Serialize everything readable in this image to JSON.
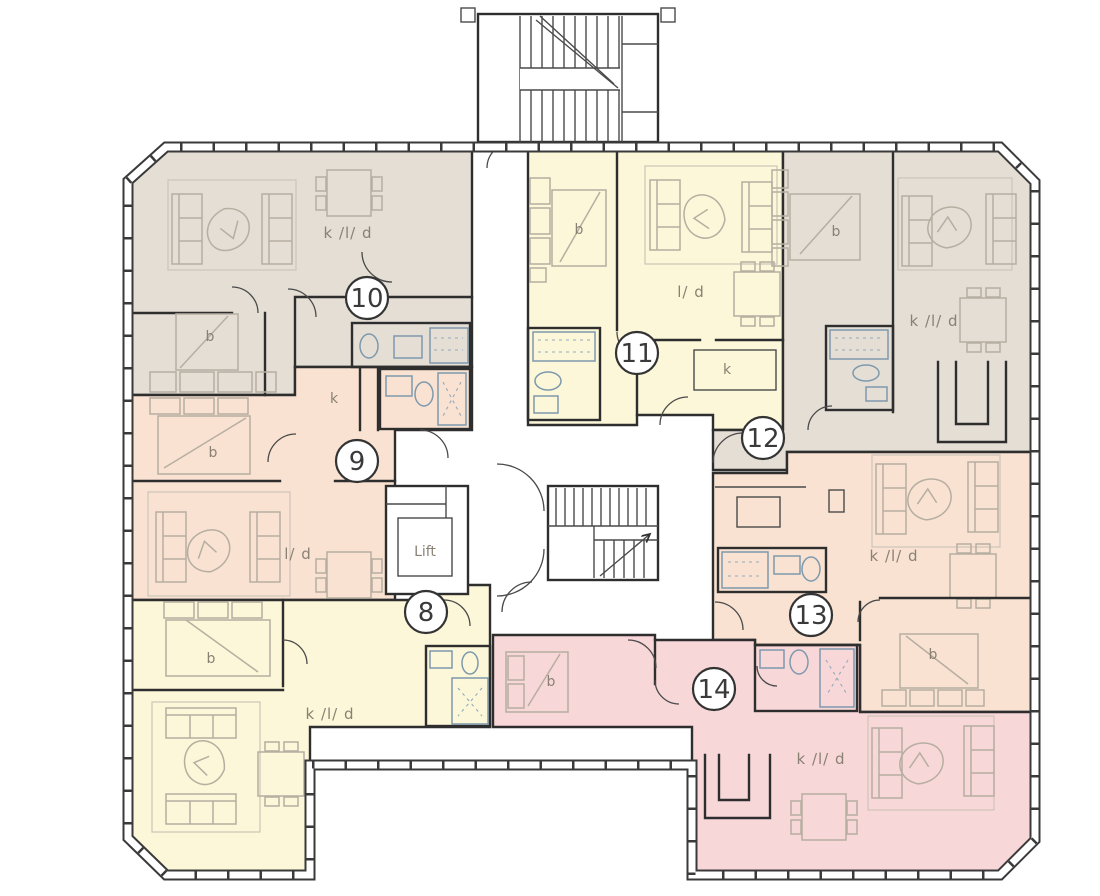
{
  "plan_title": "Residential floor plan, units 8-14",
  "colors": {
    "unit_beige": "#e4ded5",
    "unit_peach": "#f9e2d1",
    "unit_yellow": "#fbf7d8",
    "unit_pink": "#f8d7d9",
    "bathroom_blue": "#cfe6f4",
    "wall": "#3a3a3a"
  },
  "core": {
    "lift_label": "Lift"
  },
  "units": [
    {
      "number": "8",
      "type_labels": {
        "bed": "b",
        "kld": "k /l/ d"
      }
    },
    {
      "number": "9",
      "type_labels": {
        "bed": "b",
        "kitchen": "k",
        "living": "l/ d"
      }
    },
    {
      "number": "10",
      "type_labels": {
        "bed": "b",
        "kld": "k /l/ d"
      }
    },
    {
      "number": "11",
      "type_labels": {
        "bed": "b",
        "kitchen": "k",
        "living": "l/ d"
      }
    },
    {
      "number": "12",
      "type_labels": {
        "bed": "b",
        "kld": "k /l/ d"
      }
    },
    {
      "number": "13",
      "type_labels": {
        "bed": "b",
        "kld": "k /l/ d"
      }
    },
    {
      "number": "14",
      "type_labels": {
        "bed": "b",
        "kld": "k /l/ d"
      }
    }
  ]
}
